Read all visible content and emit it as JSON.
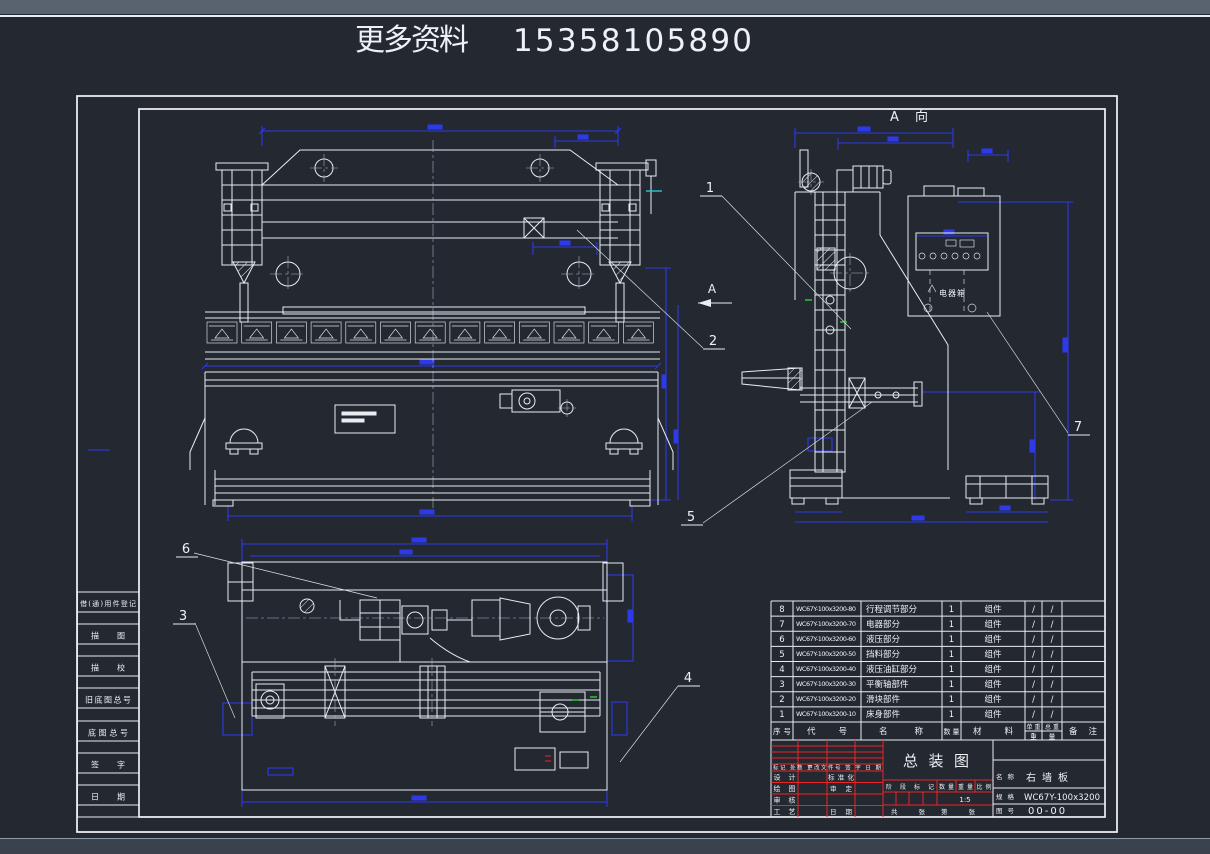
{
  "header": {
    "text": "更多资料",
    "phone": "15358105890"
  },
  "margin_labels": [
    "借(通)用件登记",
    "描  图",
    "描  校",
    "旧底图总号",
    "底图总号",
    "签  字",
    "日  期"
  ],
  "views": {
    "side_label": "A 向",
    "arrow_label": "A",
    "cabinet_label": "电器箱"
  },
  "balloons": {
    "b1": "1",
    "b2": "2",
    "b3": "3",
    "b4": "4",
    "b5": "5",
    "b6": "6",
    "b7": "7"
  },
  "parts_table": {
    "headers": {
      "seq": "序号",
      "code": "代  号",
      "name": "名  称",
      "qty": "数量",
      "material": "材  料",
      "unit_weight": "单重",
      "total_weight": "总重",
      "weight_char1": "重",
      "weight_char2": "量",
      "remark": "备 注"
    },
    "rows": [
      {
        "seq": "8",
        "code": "WC67Y-100x3200-80",
        "name": "行程调节部分",
        "qty": "1",
        "material": "组件",
        "unit": "/",
        "total": "/"
      },
      {
        "seq": "7",
        "code": "WC67Y-100x3200-70",
        "name": "电器部分",
        "qty": "1",
        "material": "组件",
        "unit": "/",
        "total": "/"
      },
      {
        "seq": "6",
        "code": "WC67Y-100x3200-60",
        "name": "液压部分",
        "qty": "1",
        "material": "组件",
        "unit": "/",
        "total": "/"
      },
      {
        "seq": "5",
        "code": "WC67Y-100x3200-50",
        "name": "挡料部分",
        "qty": "1",
        "material": "组件",
        "unit": "/",
        "total": "/"
      },
      {
        "seq": "4",
        "code": "WC67Y-100x3200-40",
        "name": "液压油缸部分",
        "qty": "1",
        "material": "组件",
        "unit": "/",
        "total": "/"
      },
      {
        "seq": "3",
        "code": "WC67Y-100x3200-30",
        "name": "平衡轴部件",
        "qty": "1",
        "material": "组件",
        "unit": "/",
        "total": "/"
      },
      {
        "seq": "2",
        "code": "WC67Y-100x3200-20",
        "name": "滑块部件",
        "qty": "1",
        "material": "组件",
        "unit": "/",
        "total": "/"
      },
      {
        "seq": "1",
        "code": "WC67Y-100x3200-10",
        "name": "床身部件",
        "qty": "1",
        "material": "组件",
        "unit": "/",
        "total": "/"
      }
    ]
  },
  "title_block": {
    "revision_header": "标记 处数 更改文件号 签 字 日 期",
    "roles": [
      "设计",
      "绘图",
      "审核",
      "工艺"
    ],
    "roles2": [
      "标准化",
      "审定",
      "",
      "日期"
    ],
    "main_title": "总装图",
    "stage_label": "阶 段 标 记",
    "qty_label": "数量",
    "weight_label": "重量",
    "scale_label": "比例",
    "scale_value": "1:5",
    "sheet_left": "共    张",
    "sheet_right": "第    张",
    "name_label": "名称",
    "name_value": "右墙板",
    "spec_label": "规格",
    "spec_value": "WC67Y-100x3200",
    "dwg_label": "图号",
    "dwg_value": "00-00"
  }
}
